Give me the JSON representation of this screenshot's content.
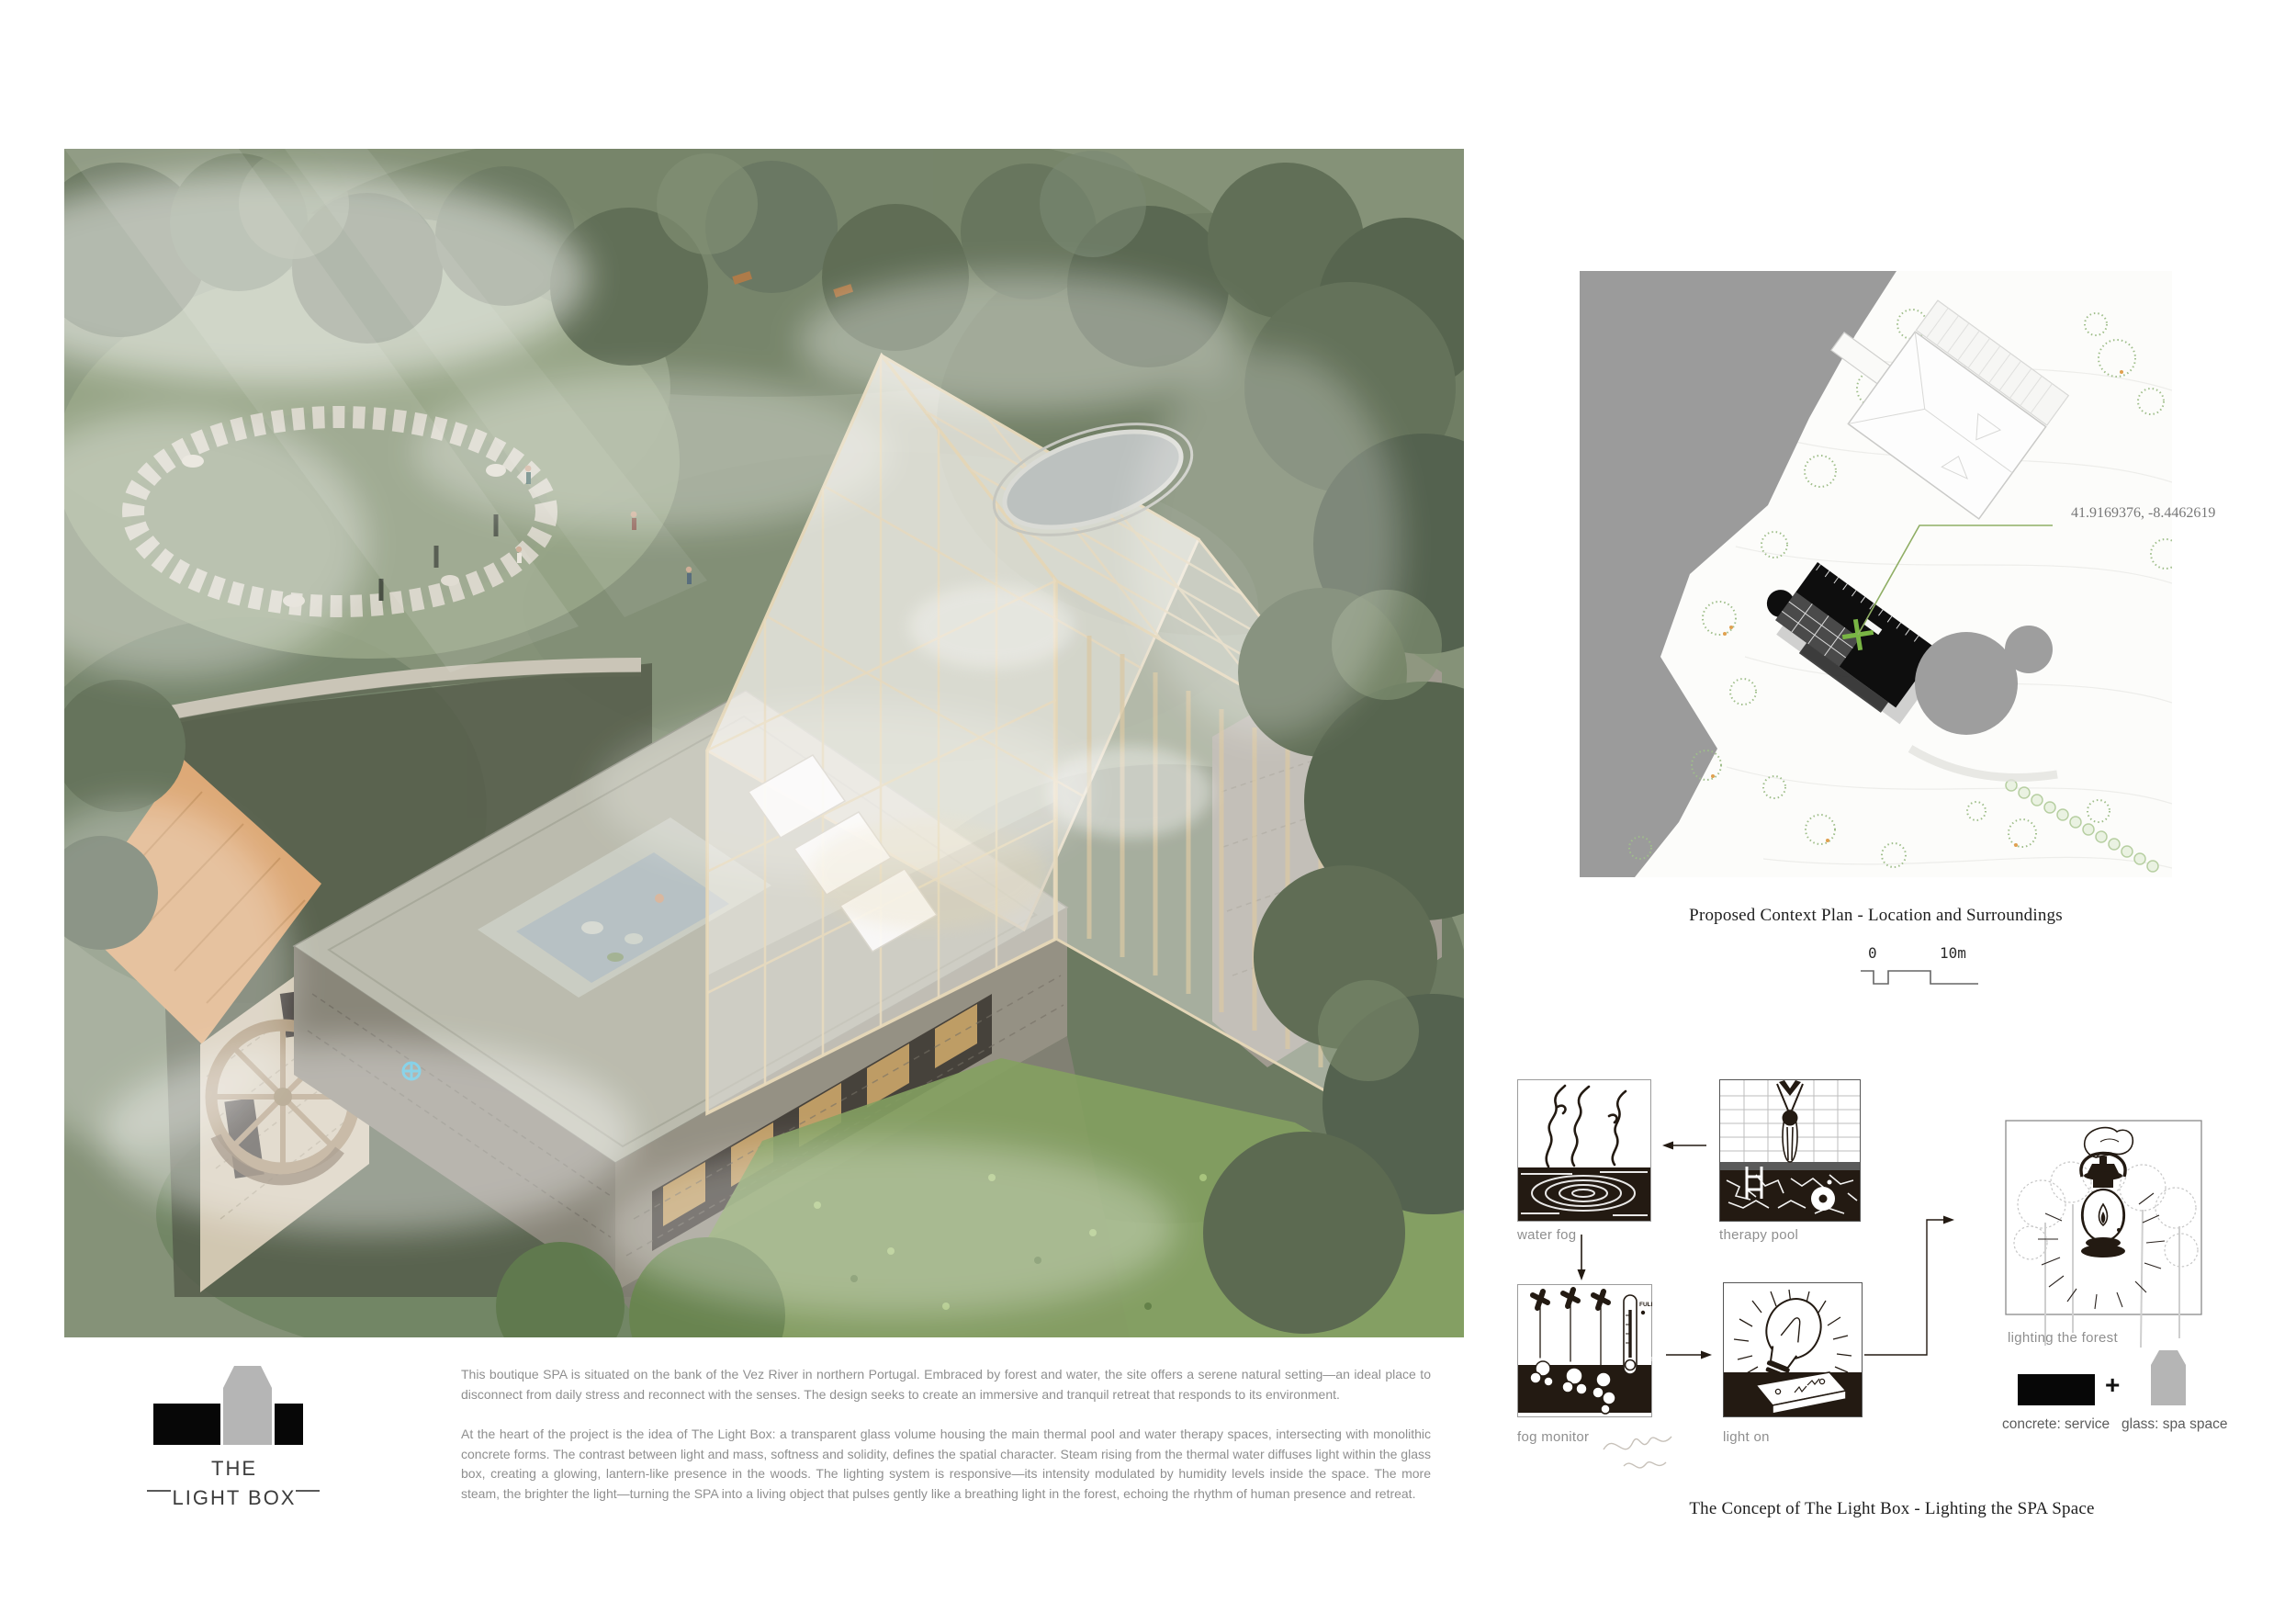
{
  "logo": {
    "line1": "THE",
    "line2": "LIGHT BOX"
  },
  "description": {
    "paragraph1": "This boutique SPA is situated on the bank of the Vez River in northern Portugal. Embraced by forest and water, the site offers a serene natural setting—an ideal place to disconnect from daily stress and reconnect with the senses. The design seeks to create an immersive and tranquil retreat that responds to its environment.",
    "paragraph2": "At the heart of the project is the idea of The Light Box: a transparent glass volume housing the main thermal pool and water therapy spaces, intersecting with monolithic concrete forms. The contrast between light and mass, softness and solidity, defines the spatial character. Steam rising from the thermal water diffuses light within the glass box, creating a glowing, lantern-like presence in the woods. The lighting system is responsive—its intensity modulated by humidity levels inside the space. The more steam, the brighter the light—turning the SPA into a living object that pulses gently like a breathing light in the forest, echoing the rhythm of human presence and retreat."
  },
  "context_plan": {
    "caption": "Proposed Context Plan - Location and Surroundings",
    "coordinates": "41.9169376, -8.4462619",
    "scale_start": "0",
    "scale_end": "10m"
  },
  "concept": {
    "caption": "The Concept of The Light Box - Lighting the SPA Space",
    "labels": {
      "water_fog": "water fog",
      "therapy_pool": "therapy pool",
      "fog_monitor": "fog monitor",
      "light_on": "light on",
      "lighting_forest": "lighting the forest"
    },
    "monitor": {
      "full": "FULL",
      "empty": "EMPTY"
    },
    "legend": {
      "concrete": "concrete: service",
      "plus": "+",
      "glass": "glass: spa space"
    }
  },
  "colors": {
    "accent_green": "#76b043",
    "river_gray": "#9b9b9b",
    "ink": "#231a12",
    "label_gray": "#8f8f8f",
    "timber": "#e6d9bc",
    "concrete": "#b7b9aa",
    "roof_orange": "#dca56f",
    "logo_gray": "#b5b5b5"
  }
}
